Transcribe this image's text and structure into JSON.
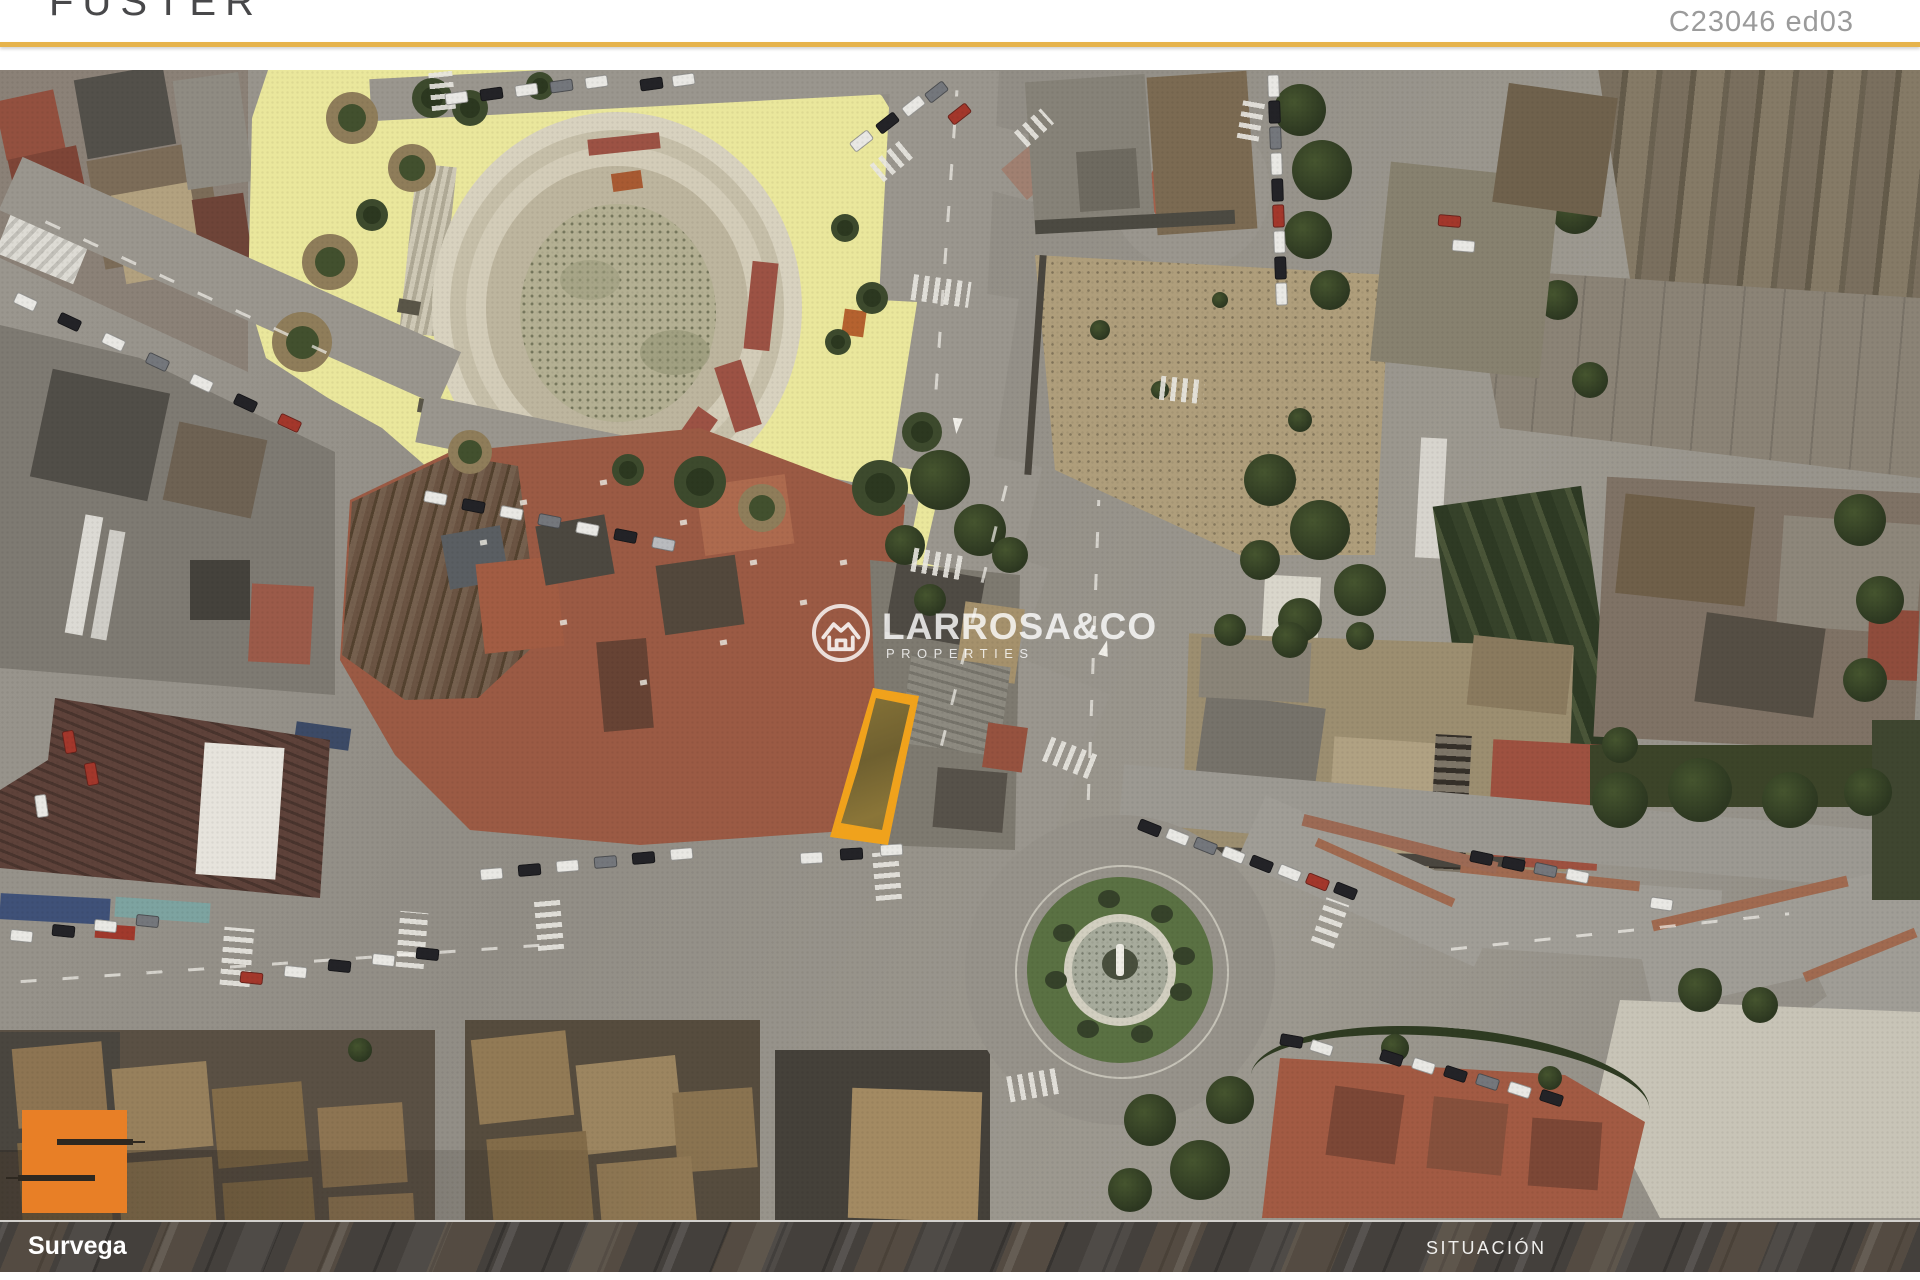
{
  "header": {
    "brand": "FUSTER",
    "reference": "C23046 ed03"
  },
  "watermark": {
    "line1": "LARROSA&CO",
    "line2": "PROPERTIES"
  },
  "footer": {
    "left_label": "Survega",
    "right_label": "SITUACIÓN"
  },
  "colors": {
    "accent_gold": "#e6b34c",
    "logo_orange": "#e87f26",
    "plot_highlight": "#f0a21c",
    "plaza_yellow": "#eae79c"
  }
}
